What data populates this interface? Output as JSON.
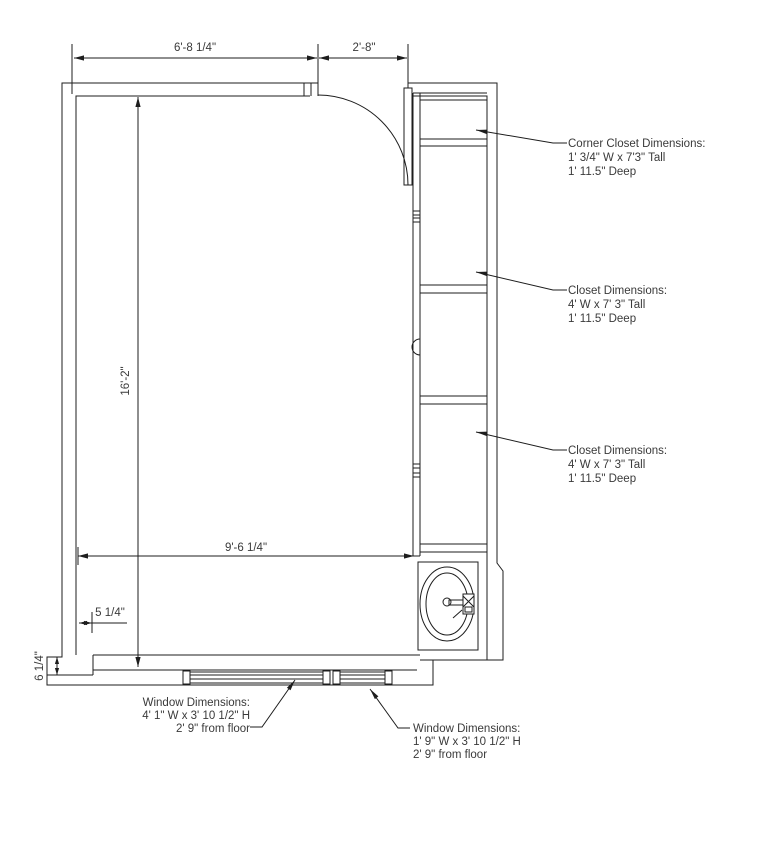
{
  "page": {
    "title": "Room Floor Plan",
    "background": "#ffffff",
    "line_color": "#1d1d1d",
    "text_color": "#3a3a3a"
  },
  "dimensions": {
    "top_left_width": "6'-8 1/4\"",
    "door_opening_width": "2'-8\"",
    "room_length": "16'-2\"",
    "room_width": "9'-6 1/4\"",
    "wall_notch": "5 1/4\"",
    "wall_step": "6 1/4\""
  },
  "annotations": {
    "corner_closet": {
      "lines": [
        "Corner Closet Dimensions:",
        "1' 3/4\" W x 7'3\" Tall",
        "1' 11.5\" Deep"
      ]
    },
    "closet_upper": {
      "lines": [
        "Closet Dimensions:",
        "4' W x 7' 3\" Tall",
        "1' 11.5\" Deep"
      ]
    },
    "closet_lower": {
      "lines": [
        "Closet Dimensions:",
        "4' W x 7' 3\" Tall",
        "1' 11.5\" Deep"
      ]
    },
    "window_left": {
      "lines": [
        "Window Dimensions:",
        "4' 1\" W x 3' 10 1/2\" H",
        "2' 9\" from floor"
      ]
    },
    "window_right": {
      "lines": [
        "Window Dimensions:",
        "1' 9\" W x 3' 10 1/2\" H",
        "2' 9\" from floor"
      ]
    }
  }
}
